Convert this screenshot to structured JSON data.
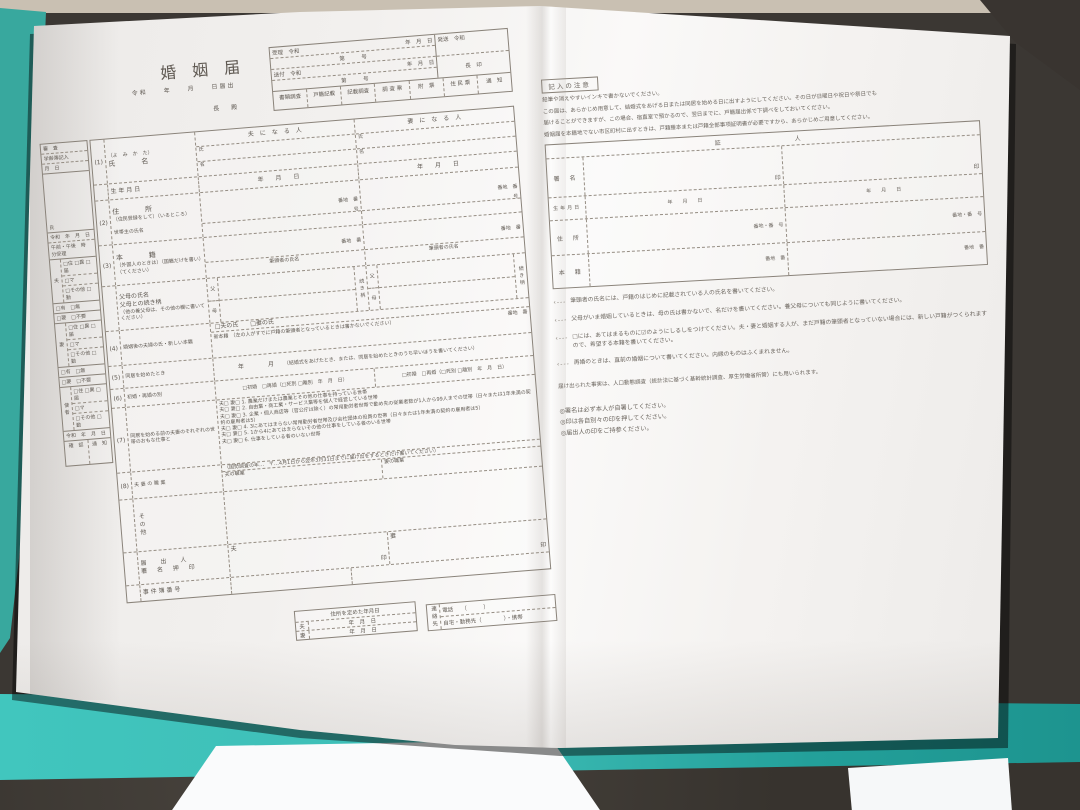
{
  "photo": {
    "floor_color": "#3b3733",
    "teal_color": "#38a89e",
    "teal_bright": "#41c6be",
    "paper_color": "#f2f0ee"
  },
  "common": {
    "ymd": "年　　月　　日",
    "ymd_tight": "年　月　日",
    "era": "令和",
    "dai_go": "第　　　号",
    "banchi_ban": "番地　番",
    "go": "号",
    "seal": "印",
    "husband": "夫",
    "wife": "妻",
    "uji": "氏",
    "na": "名",
    "father": "父",
    "mother": "母",
    "tsuzuki": "続き柄",
    "have": "□有　□無",
    "need": "□要　□不要"
  },
  "form": {
    "title": "婚　姻　届",
    "date_line": "令和　　年　　月　　日届出",
    "addressee": "長　殿",
    "receipt": {
      "r1_label": "受理　令和",
      "r2_label": "送付　令和",
      "dispatch_label": "発送　令和",
      "chief_seal": "長　印",
      "stamps": [
        "書類調査",
        "戸籍記載",
        "記載調査",
        "調 査 票",
        "附　票",
        "住 民 票",
        "通　知"
      ]
    },
    "header": {
      "husband_col": "夫　に　な　る　人",
      "wife_col": "妻　に　な　る　人"
    },
    "rows": {
      "r1_no": "(1)",
      "r1_kana": "（よ　み　か　た）",
      "r1_label": "氏　　名",
      "birth_label": "生 年 月 日",
      "r2_no": "(2)",
      "r2_label": "住　　所",
      "r2_note": "（住民登録をして）（いるところ）",
      "setainushi": "世帯主の氏名",
      "r3_no": "(3)",
      "r3_label": "本　　籍",
      "r3_note": "（外国人のときは）（国籍だけを書い）（てください）",
      "hittosha": "筆頭者の氏名",
      "parents_label": "父母の氏名",
      "parents_label2": "父母との続き柄",
      "parents_note": "（他の養父母は、その他の欄に書いてください）",
      "r4_no": "(4)",
      "r4_label": "婚姻後の夫婦の氏・新しい本籍",
      "r4_check": "□夫の氏　　□妻の氏",
      "r4_shinhonseki": "新本籍",
      "r4_note": "（左の人がすでに戸籍の筆頭者となっているときは書かないでください）",
      "r5_no": "(5)",
      "r5_label": "同居を始めたとき",
      "r5_value": "年　　　　月",
      "r5_note": "（結婚式をあげたとき、または、同居を始めたときのうち早いほうを書いてください）",
      "r6_no": "(6)",
      "r6_label": "初婚・再婚の別",
      "r6_h": "□初婚　□再婚（□死別 □離別　年　月　日）",
      "r6_w": "□初婚　□再婚（□死別 □離別　年　月　日）",
      "r7_no": "(7)",
      "r7_label": "同居を始める前の夫妻のそれぞれの世帯のおもな仕事と",
      "r7_items": [
        "夫□ 妻□ 1. 農業だけまたは農業とその他の仕事を持っている世帯",
        "夫□ 妻□ 2. 自由業・商工業・サービス業等を個人で経営している世帯",
        "夫□ 妻□ 3. 企業・個人商店等（官公庁は除く）の常用勤労者世帯で勤め先の従業者数が1人から99人までの世帯（日々または1年未満の契約の雇用者は5）",
        "夫□ 妻□ 4. 3にあてはまらない常用勤労者世帯及び会社団体の役員の世帯（日々または1年未満の契約の雇用者は5）",
        "夫□ 妻□ 5. 1から4にあてはまらないその他の仕事をしている者のいる世帯",
        "夫□ 妻□ 6. 仕事をしている者のいない世帯"
      ],
      "r8_no": "(8)",
      "r8_label": "夫 妻 の 職 業",
      "r8_note": "（国勢調査の年…　〒…4月1日から翌年3月31日までに届け出をするときだけ書いてください）",
      "husband_job": "夫の職業",
      "wife_job": "妻の職業",
      "other_label": "その他",
      "declarant_label1": "届　出　人",
      "declarant_label2": "署 名 押 印",
      "case_no_label": "事 件 簿 番 号"
    },
    "bottom": {
      "address_set_label": "住所を定めた年月日",
      "contact_label": "連絡先",
      "tel": "電話　　（　　　）",
      "tel2": "自宅・勤務先（　　　　）・携帯"
    },
    "sidebar": {
      "top1": "審　査",
      "top2": "学齢簿記入",
      "top3": "月　日",
      "uji_row": "氏",
      "time1": "令和　年　月　日",
      "time2": "午前・午後　時　分受理",
      "checks1": "□住 □異 □届",
      "checks2": "□マ",
      "checks3": "□その他 □勤",
      "messenger": "使者",
      "date_row": "令和　年　月　日",
      "confirm": "確　認",
      "notice": "通　知"
    }
  },
  "notes": {
    "header": "記入の注意",
    "paragraphs": [
      "鉛筆や消えやすいインキで書かないでください。",
      "この届は、あらかじめ用意して、結婚式をあげる日または同居を始める日に出すようにしてください。その日が日曜日や祝日や祭日でも",
      "届けることができますが、この場合、宿直室で預かるので、翌日までに、戸籍届出係で下調べをしておいてください。",
      "婚姻届を本籍地でない市区町村に出すときは、戸籍謄本または戸籍全部事項証明書が必要ですから、あらかじめご用意してください。"
    ],
    "witness": {
      "title": "証　　　　人",
      "sign_label": "署　名",
      "birth_label": "生年月日",
      "addr_label": "住　所",
      "honseki_label": "本　籍",
      "banchi_bango": "番地・番　号"
    },
    "bullets": [
      "筆頭者の氏名には、戸籍のはじめに記載されている人の氏名を書いてください。",
      "父母がいま婚姻しているときは、母の氏は書かないで、名だけを書いてください。養父母についても同じように書いてください。",
      "□には、あてはまるものに☑のようにしるしをつけてください。夫・妻と婚姻する人が、まだ戸籍の筆頭者となっていない場合には、新しい戸籍がつくられますので、希望する本籍を書いてください。",
      "再婚のときは、直前の婚姻について書いてください。内縁のものはふくまれません。"
    ],
    "stat_note": "届け出られた事実は、人口動態調査（統計法に基づく基幹統計調査、厚生労働省所管）にも用いられます。",
    "footnotes": [
      "◎署名は必ず本人が自署してください。",
      "◎印は各自別々の印を押してください。",
      "◎届出人の印をご持参ください。"
    ]
  }
}
